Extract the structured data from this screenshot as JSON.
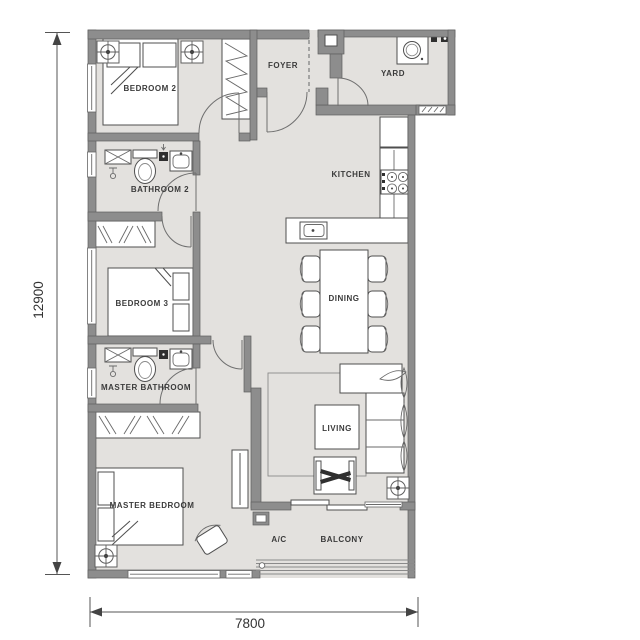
{
  "rooms": {
    "bedroom2": "BEDROOM 2",
    "foyer": "FOYER",
    "yard": "YARD",
    "bathroom2": "BATHROOM 2",
    "kitchen": "KITCHEN",
    "bedroom3": "BEDROOM 3",
    "dining": "DINING",
    "master_bathroom": "MASTER BATHROOM",
    "living": "LIVING",
    "master_bedroom": "MASTER BEDROOM",
    "ac": "A/C",
    "balcony": "BALCONY"
  },
  "dimensions": {
    "overall_depth_mm": "12900",
    "overall_width_mm": "7800"
  },
  "icons": {
    "ac_unit": "circle-cross-in-square",
    "washing_machine": "front-load-washer-drum",
    "toilet": "tank-and-bowl",
    "basin": "rect-basin-with-tap",
    "shower": "rect-with-x-and-head",
    "stove": "four-burner-hob",
    "sink": "single-bowl-sink",
    "wardrobe": "zigzag-hatch",
    "door": "quarter-arc-swing"
  },
  "colors": {
    "floor": "#e3e1de",
    "wall": "#8d8d8d",
    "wall_edge": "#5f5f5f",
    "line": "#4f4f4f",
    "text": "#3b3b3b",
    "background": "#ffffff"
  }
}
